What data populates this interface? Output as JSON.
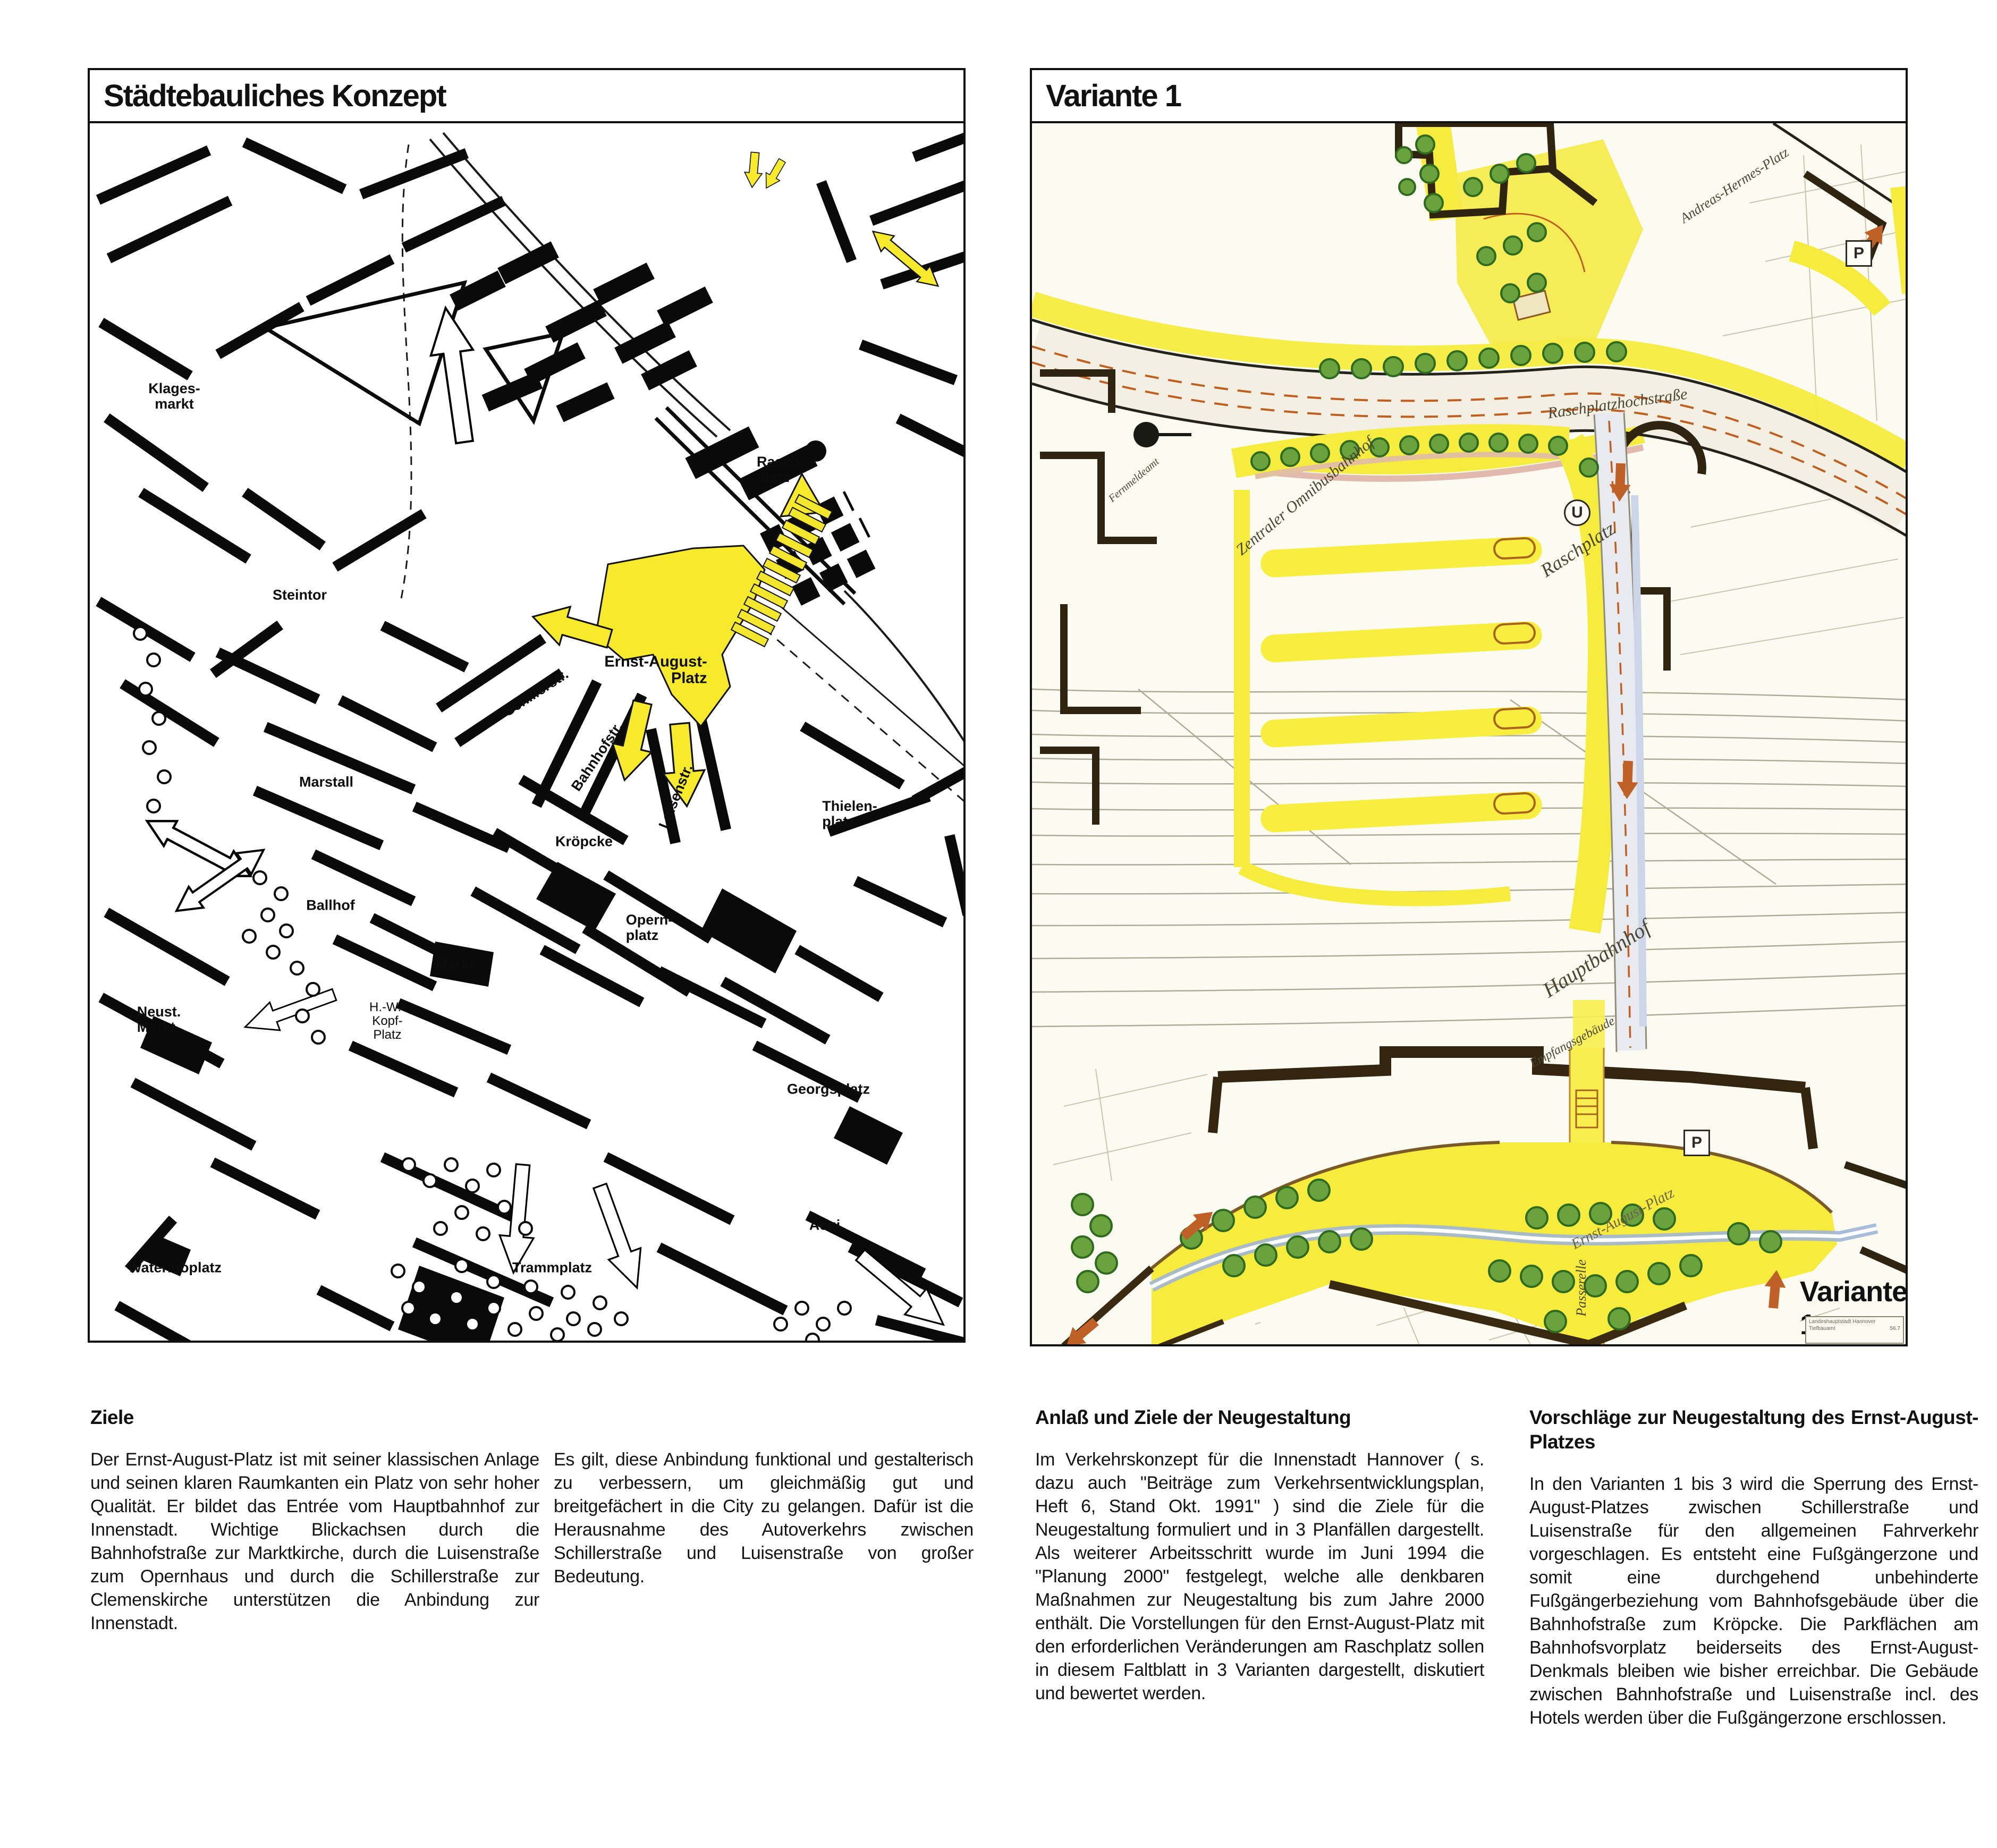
{
  "left_panel": {
    "title": "Städtebauliches Konzept"
  },
  "right_panel": {
    "title": "Variante 1",
    "map_caption": "Variante 1",
    "titleblock_line1": "Landeshauptstadt Hannover",
    "titleblock_line2": "Tiefbauamt",
    "titleblock_number": "56.7"
  },
  "left_map": {
    "labels": [
      {
        "text": "Klages-\nmarkt"
      },
      {
        "text": "Steintor"
      },
      {
        "text": "Rasch-\nplatz"
      },
      {
        "text": "Ernst-August-\nPlatz"
      },
      {
        "text": "Schillerstr."
      },
      {
        "text": "Bahnhofstr."
      },
      {
        "text": "Luisenstr."
      },
      {
        "text": "Kröpcke"
      },
      {
        "text": "Opern-\nplatz"
      },
      {
        "text": "Thielen-\nplatz"
      },
      {
        "text": "Marstall"
      },
      {
        "text": "Ballhof"
      },
      {
        "text": "Markt"
      },
      {
        "text": "Neust.\nMarkt"
      },
      {
        "text": "H.-W.-\nKopf-\nPlatz"
      },
      {
        "text": "Georgsplatz"
      },
      {
        "text": "Waterlooplatz"
      },
      {
        "text": "Trammplatz"
      },
      {
        "text": "Aegi"
      }
    ]
  },
  "right_map": {
    "labels": [
      {
        "text": "Raschplatzhochstraße"
      },
      {
        "text": "Raschplatz"
      },
      {
        "text": "Andreas-Hermes-Platz"
      },
      {
        "text": "Hauptbahnhof"
      },
      {
        "text": "Empfangsgebäude"
      },
      {
        "text": "Zentraler Omnibusbahnhof"
      },
      {
        "text": "Fernmeldeamt"
      },
      {
        "text": "Passerelle"
      },
      {
        "text": "Ernst-August-Platz"
      }
    ],
    "parking_symbol": "P",
    "subway_symbol": "U"
  },
  "columns": [
    {
      "heading": "Ziele",
      "body": "Der Ernst-August-Platz ist mit seiner klassischen Anlage und seinen klaren Raumkanten ein Platz von sehr hoher Qualität. Er bildet das Entrée vom Hauptbahnhof zur Innenstadt. Wichtige Blickachsen durch die Bahnhofstraße zur Marktkirche, durch die Luisenstraße zum Opernhaus und durch die Schillerstraße zur Clemenskirche unterstützen die Anbindung zur Innenstadt."
    },
    {
      "heading": "",
      "body": "Es gilt, diese Anbindung funktional und gestalterisch zu verbessern, um gleichmäßig gut und breitgefächert in die City zu gelangen. Dafür ist die Herausnahme des Autoverkehrs zwischen Schillerstraße und Luisenstraße von großer Bedeutung."
    },
    {
      "heading": "Anlaß und Ziele der Neugestaltung",
      "body": "Im Verkehrskonzept für die Innenstadt Hannover ( s. dazu auch \"Beiträge zum Verkehrsentwicklungsplan, Heft 6, Stand Okt. 1991\" ) sind die Ziele für die Neugestaltung formuliert und in 3 Planfällen dargestellt. Als weiterer Arbeitsschritt wurde im Juni 1994 die \"Planung 2000\" festgelegt, welche alle denkbaren Maßnahmen zur Neugestaltung bis zum Jahre 2000 enthält. Die Vorstellungen für den Ernst-August-Platz mit den erforderlichen Veränderungen am Raschplatz sollen in diesem Faltblatt in 3 Varianten dargestellt, diskutiert und bewertet werden."
    },
    {
      "heading": "Vorschläge zur Neugestaltung des Ernst-August-Platzes",
      "body": "In den Varianten 1 bis 3 wird die Sperrung des Ernst-August-Platzes zwischen Schillerstraße und Luisenstraße für den allgemeinen Fahrverkehr vorgeschlagen. Es entsteht eine Fußgängerzone und somit eine durchgehend unbehinderte Fußgängerbeziehung vom Bahnhofsgebäude über die Bahnhofstraße zum Kröpcke. Die Parkflächen am Bahnhofsvorplatz beiderseits des Ernst-August-Denkmals bleiben wie bisher erreichbar. Die Gebäude zwischen Bahnhofstraße und Luisenstraße incl. des Hotels werden über die Fußgängerzone erschlossen."
    }
  ],
  "colors": {
    "highlight_yellow": "#f6e93c",
    "tree_green": "#5c9c3a",
    "tram_blue": "#9fb6d6",
    "accent_orange": "#bf6126",
    "building_brown": "#34260f"
  }
}
